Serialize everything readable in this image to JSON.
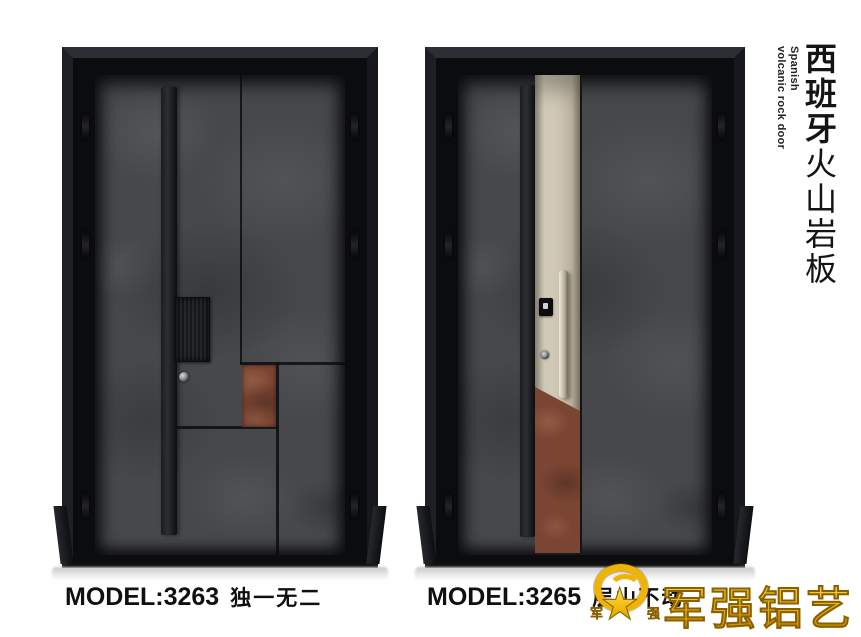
{
  "side_title": {
    "english_line1": "Spanish",
    "english_line2": "volcanic rock door",
    "chinese_bold": "西班牙",
    "chinese_light": "火山岩板"
  },
  "products": [
    {
      "model_label": "MODEL:3263",
      "tagline": "独一无二"
    },
    {
      "model_label": "MODEL:3265",
      "tagline": "层山不动"
    }
  ],
  "brand": {
    "wordmark": "军强铝艺",
    "badge_char_left": "军",
    "badge_char_right": "强",
    "badge_star": "★"
  },
  "colors": {
    "frame_black": "#141518",
    "stone_gray": "#46484c",
    "rust_accent": "#7b4533",
    "champagne_accent": "#cdc5b1",
    "logo_gold": "#eeb303",
    "caption_text": "#101010",
    "background": "#ffffff"
  }
}
